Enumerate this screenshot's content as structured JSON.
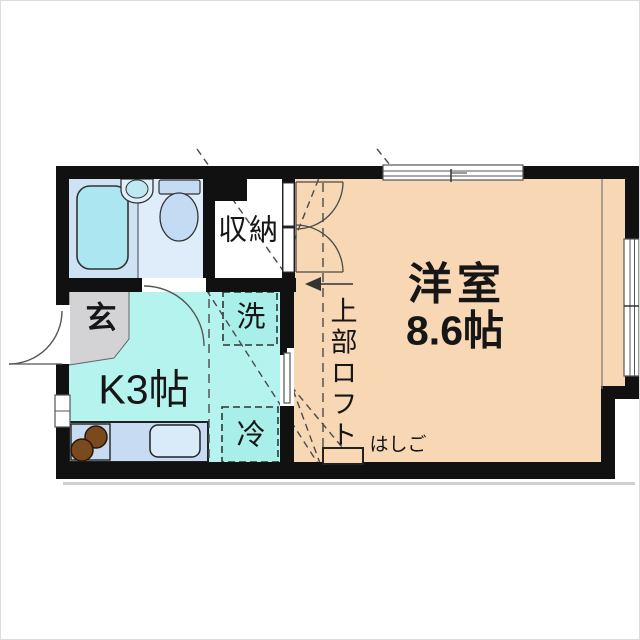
{
  "floor_plan": {
    "rooms": {
      "western_room": {
        "label": "洋室",
        "size_label": "8.6帖"
      },
      "kitchen": {
        "label": "K3帖"
      },
      "entrance": {
        "label": "玄"
      },
      "closet": {
        "label": "収納"
      },
      "loft": {
        "label": "上部ロフト"
      },
      "ladder": {
        "label": "はしご"
      },
      "washer": {
        "label": "洗"
      },
      "refrigerator": {
        "label": "冷"
      }
    },
    "colors": {
      "wall": "#111111",
      "western_room": "#f8d7b5",
      "kitchen": "#b5f4ee",
      "appliance_area": "#a9efe9",
      "bathroom": "#cfe2f4",
      "toilet_area": "#dfecf9",
      "bathtub": "#ace7f1",
      "basin": "#bfe9f2",
      "toilet": "#c3dcf4",
      "entrance_floor": "#d3d3d6",
      "counter": "#c7dcf2",
      "sink": "#d9eaf8",
      "burner": "#7a4a1e",
      "outline": "#4a4a4a"
    }
  }
}
